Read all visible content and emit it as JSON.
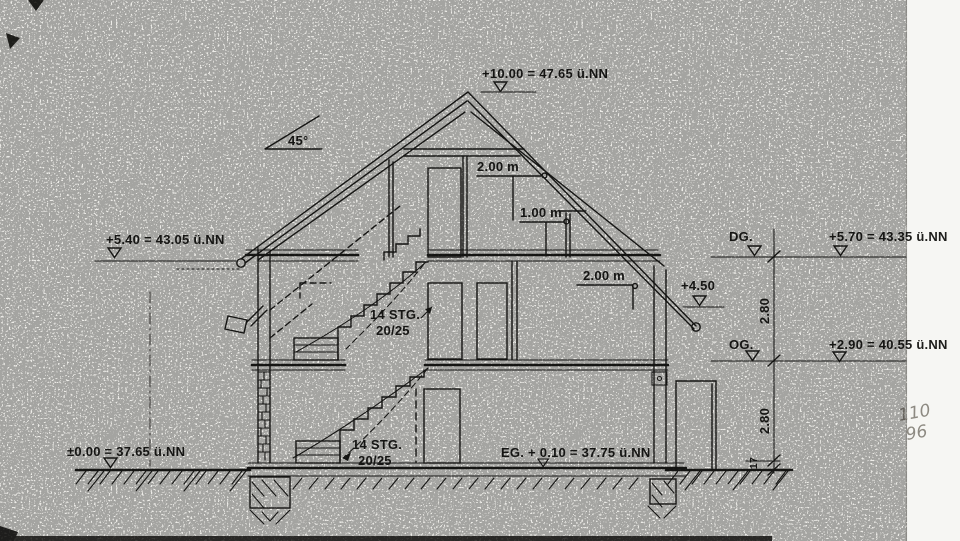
{
  "colors": {
    "ink": "#1d1d1b",
    "paper": "#edece8",
    "pencil": "#8d8a82",
    "paper_edge": "#f6f6f3"
  },
  "annotations": {
    "ridge_level": "+10.00 = 47.65 ü.NN",
    "roof_angle": "45°",
    "attic_headroom_2m": "2.00 m",
    "attic_headroom_1m": "1.00 m",
    "og_headroom_2m": "2.00 m",
    "left_eave_level": "+5.40 = 43.05 ü.NN",
    "dg_label": "DG.",
    "dg_level": "+5.70 = 43.35 ü.NN",
    "attic_floor_level": "+4.50",
    "og_label": "OG.",
    "og_level": "+2.90 = 40.55 ü.NN",
    "ground_level": "±0.00 = 37.65 ü.NN",
    "eg_level": "EG. + 0.10 = 37.75 ü.NN"
  },
  "stairs": {
    "upper": {
      "line1": "14 STG.",
      "line2": "20/25"
    },
    "lower": {
      "line1": "14 STG.",
      "line2": "20/25"
    }
  },
  "dimensions": {
    "dg_storey_height": "2.80",
    "og_storey_height": "2.80",
    "floor_step": "17"
  },
  "handwritten": {
    "line1": "110",
    "line2": "96"
  }
}
